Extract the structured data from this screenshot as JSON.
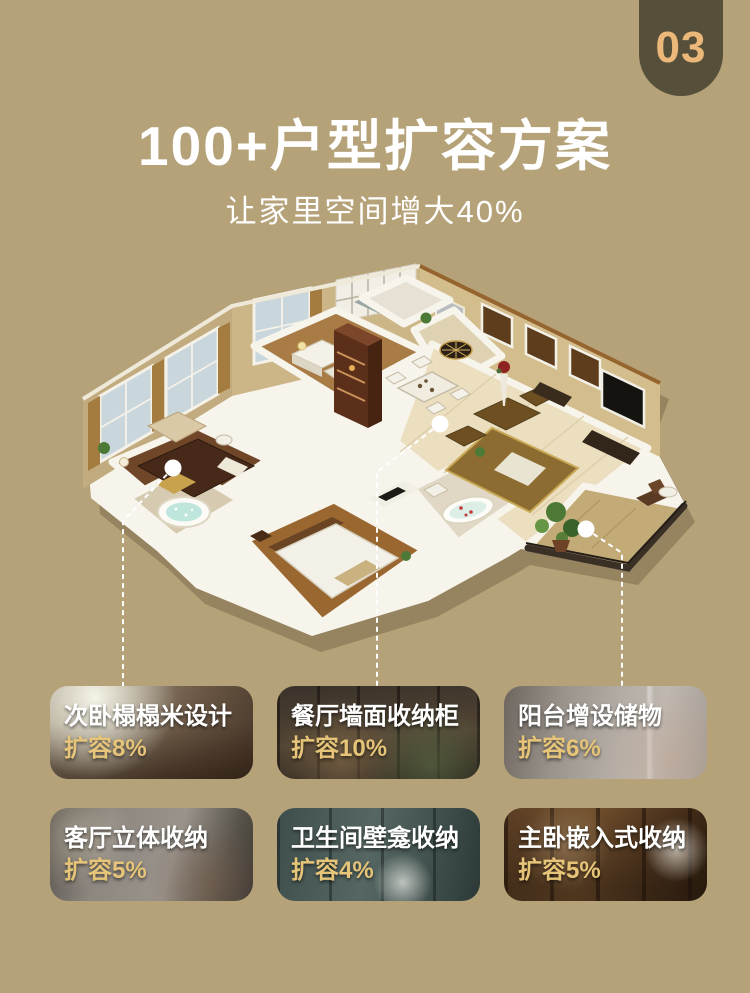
{
  "badge": {
    "number": "03"
  },
  "header": {
    "title": "100+户型扩容方案",
    "subtitle": "让家里空间增大40%"
  },
  "cards": [
    {
      "title": "次卧榻榻米设计",
      "value": "扩容8%"
    },
    {
      "title": "餐厅墙面收纳柜",
      "value": "扩容10%"
    },
    {
      "title": "阳台增设储物",
      "value": "扩容6%"
    },
    {
      "title": "客厅立体收纳",
      "value": "扩容5%"
    },
    {
      "title": "卫生间壁龛收纳",
      "value": "扩容4%"
    },
    {
      "title": "主卧嵌入式收纳",
      "value": "扩容5%"
    }
  ],
  "colors": {
    "background": "#b5a279",
    "badge_background": "#56503b",
    "badge_text": "#ecb87a",
    "heading_text": "#ffffff",
    "card_title_text": "#ffffff",
    "card_value_text": "#e6c478",
    "callout": "#ffffff"
  }
}
